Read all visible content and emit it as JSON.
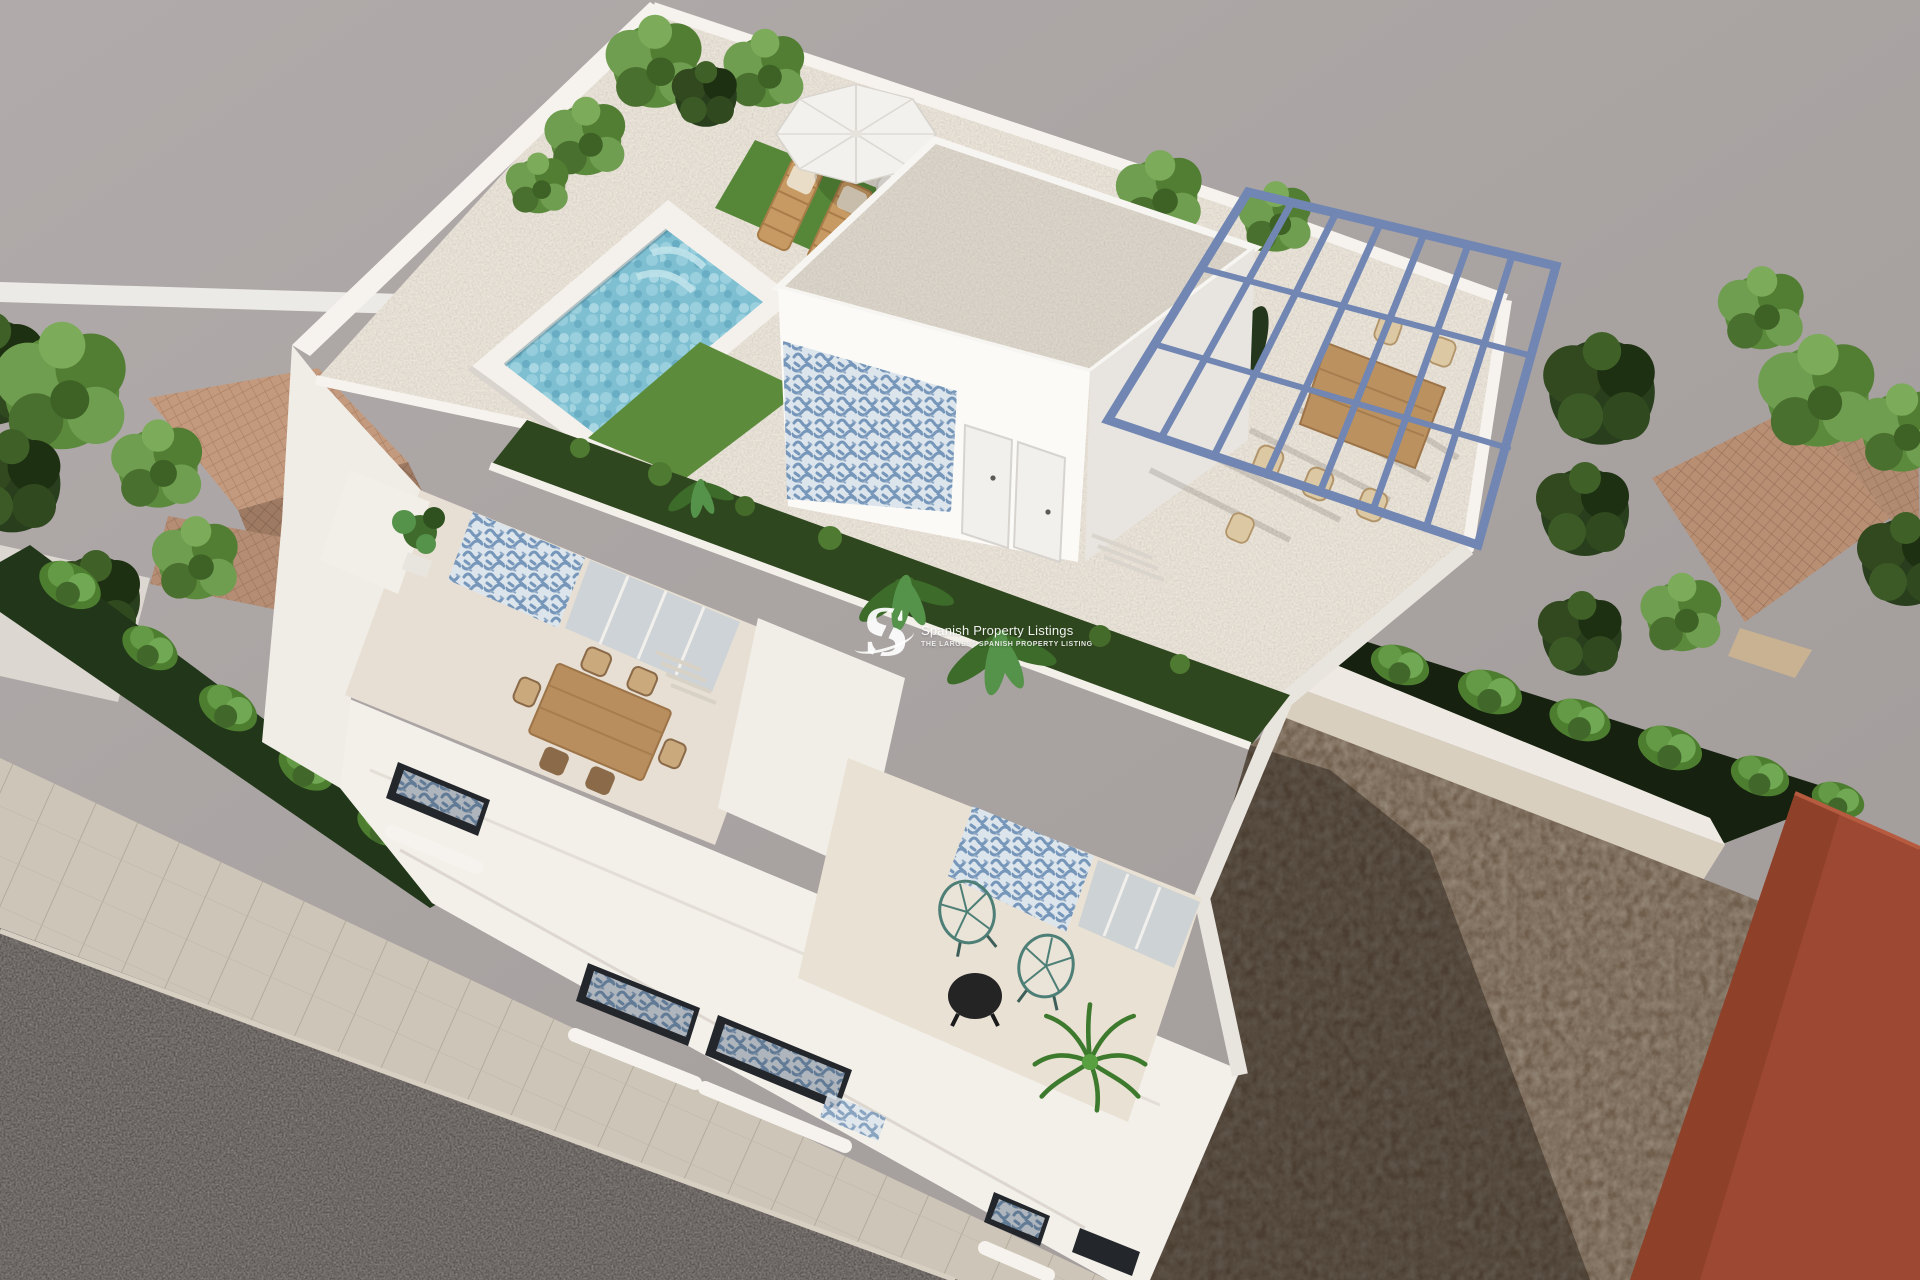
{
  "watermark": {
    "logo_letter": "S",
    "title": "Spanish Property Listings",
    "subtitle": "THE LARGEST SPANISH PROPERTY LISTING"
  },
  "scene": {
    "type": "3D architectural render, aerial view",
    "subject": "Modern white villa with rooftop solarium, plunge pool, blue steel pergola and street-facing balconies",
    "elements": [
      "rooftop-pool",
      "parasol-with-sun-loungers",
      "penthouse-with-gravel-roof",
      "blue-white-tile-mural",
      "steel-pergola",
      "pergola-dining-set",
      "artificial-grass-planters",
      "second-floor-terrace-dining-table",
      "first-floor-terrace-acapulco-chairs",
      "round-black-coffee-table",
      "potted-palm",
      "street-balconies-with-patterned-cushions",
      "sidewalk",
      "asphalt-road",
      "neighbor-terracotta-roofs",
      "perimeter-trees-and-hedges",
      "vacant-dirt-lot",
      "red-corner-building"
    ]
  },
  "palette": {
    "background": "#a8a2a1",
    "villa_white": "#f5f2ee",
    "deck": "#ece5da",
    "pool_water": "#7fbfd2",
    "pergola_blue": "#7186b2",
    "mural_blue": "#7696ba",
    "grass": "#5c8c3b",
    "grass_shadow": "#2f471e",
    "tree_bright": "#5c8a3c",
    "tree_dark": "#283e1c",
    "terracotta": "#c49a7e",
    "road": "#5c5754",
    "sidewalk": "#cdc5b7",
    "dirt": "#6f5d4c",
    "red_building": "#9c4832",
    "wood": "#bb9160"
  }
}
